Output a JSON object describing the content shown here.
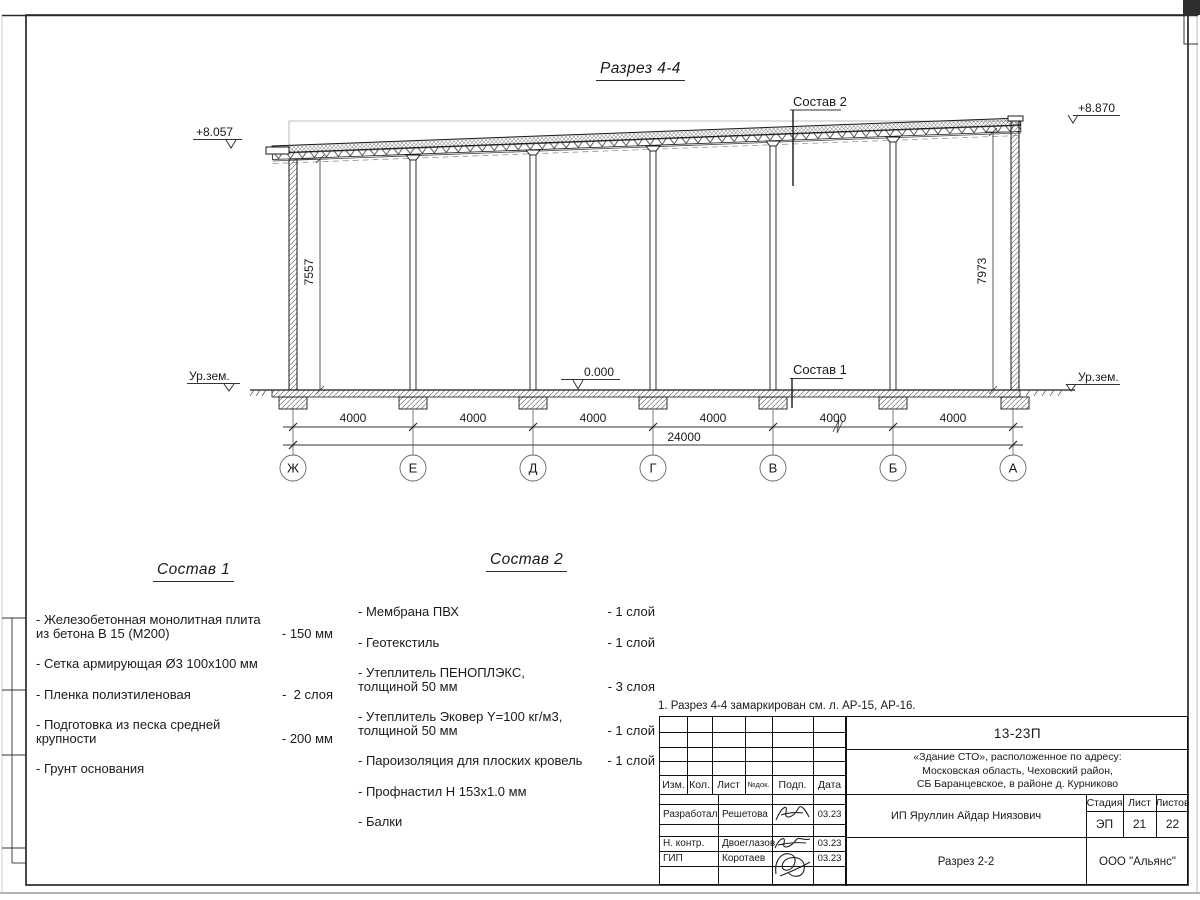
{
  "sheet": {
    "drawing_title": "Разрез 4-4",
    "note": "1. Разрез 4-4 замаркирован см. л. АР-15, АР-16."
  },
  "section": {
    "callouts": {
      "sostav2": "Состав 2",
      "sostav1": "Состав 1"
    },
    "levels": {
      "left": "+8.057",
      "right": "+8.870",
      "zero": "0.000",
      "ground_left": "Ур.зем.",
      "ground_right": "Ур.зем."
    },
    "heights": {
      "left": "7557",
      "right": "7973"
    },
    "dims": {
      "bays": [
        "4000",
        "4000",
        "4000",
        "4000",
        "4000",
        "4000"
      ],
      "total": "24000"
    },
    "axes": [
      "Ж",
      "Е",
      "Д",
      "Г",
      "В",
      "Б",
      "А"
    ]
  },
  "sostav1": {
    "title": "Состав 1",
    "items": [
      {
        "name": "- Железобетонная  монолитная плита\n  из бетона В 15 (М200)",
        "qty": "- 150 мм"
      },
      {
        "name": "- Сетка армирующая Ø3 100х100 мм",
        "qty": ""
      },
      {
        "name": "- Пленка полиэтиленовая",
        "qty": "-  2 слоя"
      },
      {
        "name": "- Подготовка из песка средней\n  крупности",
        "qty": "- 200 мм"
      },
      {
        "name": "- Грунт основания",
        "qty": ""
      }
    ]
  },
  "sostav2": {
    "title": "Состав 2",
    "items": [
      {
        "name": "- Мембрана ПВХ",
        "qty": "- 1 слой"
      },
      {
        "name": "- Геотекстиль",
        "qty": "- 1 слой"
      },
      {
        "name": "- Утеплитель ПЕНОПЛЭКС,\n  толщиной 50 мм",
        "qty": "- 3 слоя"
      },
      {
        "name": "- Утеплитель Эковер Y=100 кг/м3,\n  толщиной 50 мм",
        "qty": "- 1 слой"
      },
      {
        "name": "- Пароизоляция для плоских кровель",
        "qty": "- 1 слой"
      },
      {
        "name": "- Профнастил Н 153х1.0 мм",
        "qty": ""
      },
      {
        "name": "- Балки",
        "qty": ""
      }
    ]
  },
  "title_block": {
    "doc_number": "13-23П",
    "project": "«Здание СТО», расположенное по адресу:\nМосковская область, Чеховский район,\nСБ Баранцевское, в районе д. Курниково",
    "revision_header": [
      "Изм.",
      "Кол.",
      "Лист",
      "№док.",
      "Подп.",
      "Дата"
    ],
    "signers": [
      {
        "role": "Разработал",
        "name": "Решетова",
        "date": "03.23"
      },
      {
        "role": "Н. контр.",
        "name": "Двоеглазов",
        "date": "03.23"
      },
      {
        "role": "ГИП",
        "name": "Коротаев",
        "date": "03.23"
      }
    ],
    "client": "ИП Яруллин Айдар Ниязович",
    "sheet_title": "Разрез 2-2",
    "company": "ООО \"Альянс\"",
    "stage_header": [
      "Стадия",
      "Лист",
      "Листов"
    ],
    "stage_value": "ЭП",
    "sheet_number": "21",
    "sheets_total": "22"
  }
}
